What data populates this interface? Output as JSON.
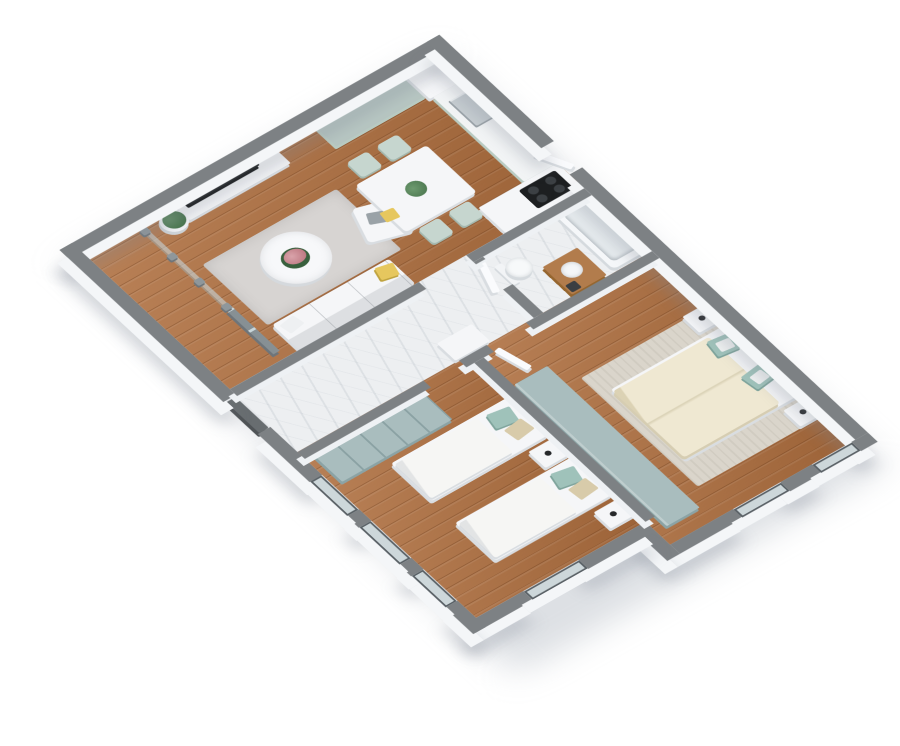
{
  "scene": {
    "type": "3d-floorplan-render",
    "view": "isometric-top-down",
    "background": "#ffffff",
    "rooms": [
      {
        "name": "living-room",
        "floor": "wood",
        "furniture": [
          "tv-stand",
          "tv",
          "potted-plant",
          "sofa",
          "yellow-pillow",
          "armchair",
          "round-coffee-table",
          "pink-flowers",
          "gray-rug"
        ]
      },
      {
        "name": "kitchen",
        "floor": "wood",
        "chair_count": 4,
        "furniture": [
          "teal-top-counter",
          "tall-cabinet",
          "sink-counter",
          "steel-sink",
          "cooktop-counter",
          "black-cooktop",
          "dining-table",
          "dining-chairs",
          "green-centerpiece"
        ]
      },
      {
        "name": "balcony",
        "floor": "wood",
        "features": [
          "glass-railing",
          "railing-posts",
          "glass-door"
        ]
      },
      {
        "name": "hallway",
        "floor": "marble",
        "furniture": [
          "console-table"
        ],
        "features": [
          "dark-entry-door"
        ]
      },
      {
        "name": "bathroom",
        "floor": "marble",
        "furniture": [
          "toilet",
          "wood-vanity",
          "bathtub"
        ],
        "features": [
          "white-door"
        ]
      },
      {
        "name": "bedroom-children",
        "floor": "wood",
        "window_count": 3,
        "furniture": [
          "single-bed-1",
          "single-bed-2",
          "nightstand-1",
          "nightstand-2",
          "teal-sliding-wardrobe"
        ]
      },
      {
        "name": "bedroom-master",
        "floor": "wood",
        "window_count": 2,
        "furniture": [
          "double-bed",
          "wood-headboard",
          "nightstand-left",
          "nightstand-right",
          "alarm-clocks",
          "teal-wardrobe",
          "beige-rug"
        ]
      }
    ],
    "palette": {
      "wall_top": "#7d8184",
      "wall_face": "#f4f6f8",
      "wood_floor": "#ae6e3e",
      "marble_floor": "#edeff1",
      "teal_furniture": "#a9bdbe",
      "counter_teal": "#b7c6c2",
      "sage_cabinet": "#b9cbc2",
      "duvet_cream": "#efe8d2",
      "pillow_teal": "#9fc2ba",
      "pillow_beige": "#d8cbaa",
      "accent_yellow": "#e6c75e",
      "rug_gray": "#d7d4d2",
      "tv_black": "#17191b",
      "door_dark": "#686d70",
      "window_frame": "#596065",
      "flower_pink": "#c78d95",
      "plant_green": "#46714a"
    }
  }
}
